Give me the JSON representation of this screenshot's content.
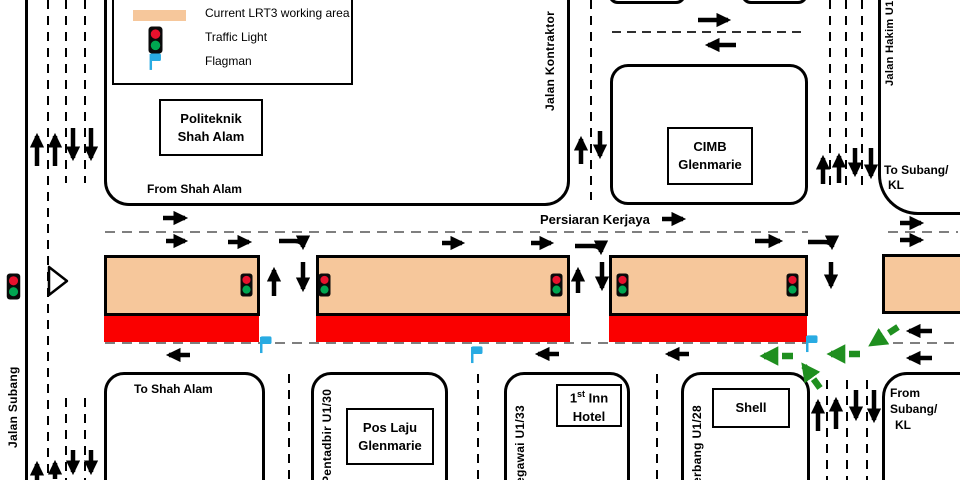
{
  "legend": {
    "work_area": "Current LRT3 working area",
    "traffic_light": "Traffic Light",
    "flagman": "Flagman"
  },
  "streets": {
    "persiaran_kerjaya": "Persiaran Kerjaya",
    "jalan_kontraktor": "Jalan Kontraktor",
    "jalan_hakim_u1": "Jalan Hakim U1",
    "jalan_subang": "Jalan Subang",
    "pentadbir_u1_30": "Pentadbir U1/30",
    "pegawai_u1_33": "egawai U1/33",
    "terbang_u1_28": "erbang U1/28"
  },
  "directions": {
    "from_shah_alam": "From Shah Alam",
    "to_shah_alam": "To Shah Alam",
    "to_subang_line1": "To Subang/",
    "to_subang_line2": "KL",
    "from_subang_line1": "From",
    "from_subang_line2": "Subang/",
    "from_subang_line3": "KL"
  },
  "landmarks": {
    "politeknik_line1": "Politeknik",
    "politeknik_line2": "Shah Alam",
    "cimb_line1": "CIMB",
    "cimb_line2": "Glenmarie",
    "poslaju_line1": "Pos Laju",
    "poslaju_line2": "Glenmarie",
    "hotel_line1_num": "1",
    "hotel_line1_sup": "st",
    "hotel_line1_rest": " Inn",
    "hotel_line2": "Hotel",
    "shell": "Shell"
  },
  "colors": {
    "work_area": "#F6C79B",
    "closure_red": "#FA0000",
    "flag_blue": "#29ABE2",
    "green_arrow": "#1F8F1F",
    "traffic_light_red": "#E8112D",
    "traffic_light_green": "#00A651",
    "lane_dash_gray": "#7F7F7F"
  }
}
